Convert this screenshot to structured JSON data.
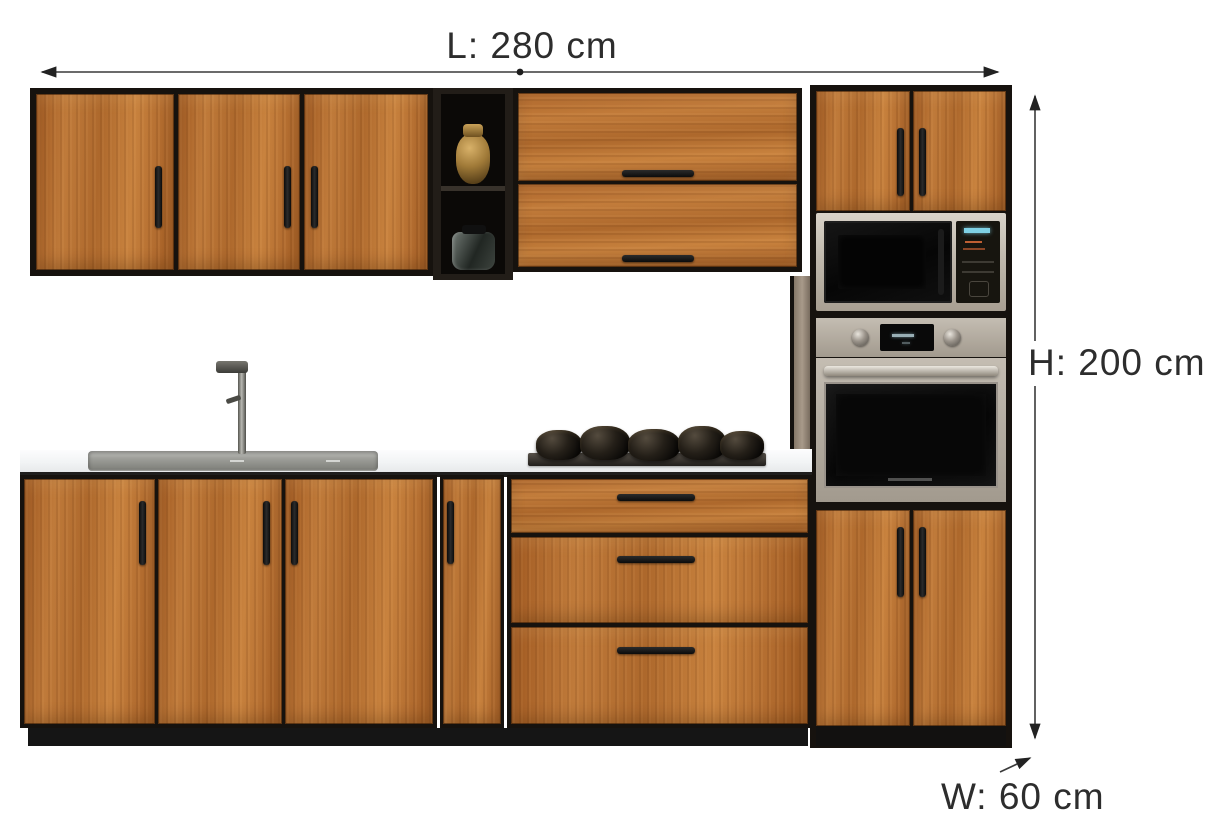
{
  "diagram": {
    "title": "kitchen-set-dimension-diagram",
    "dimensions": {
      "length_label": "L: 280 cm",
      "height_label": "H: 200 cm",
      "width_label": "W: 60 cm"
    },
    "colors": {
      "background": "#ffffff",
      "wood": "#b96f30",
      "cabinet_frame": "#16120e",
      "countertop": "#f2f4f5",
      "stainless_steel": "#c0b9ad",
      "appliance_glass": "#0a0a0a",
      "annotation_text": "#2d2d2d",
      "annotation_line": "#3a3a3a",
      "microwave_display": "#7fd0e4"
    }
  }
}
